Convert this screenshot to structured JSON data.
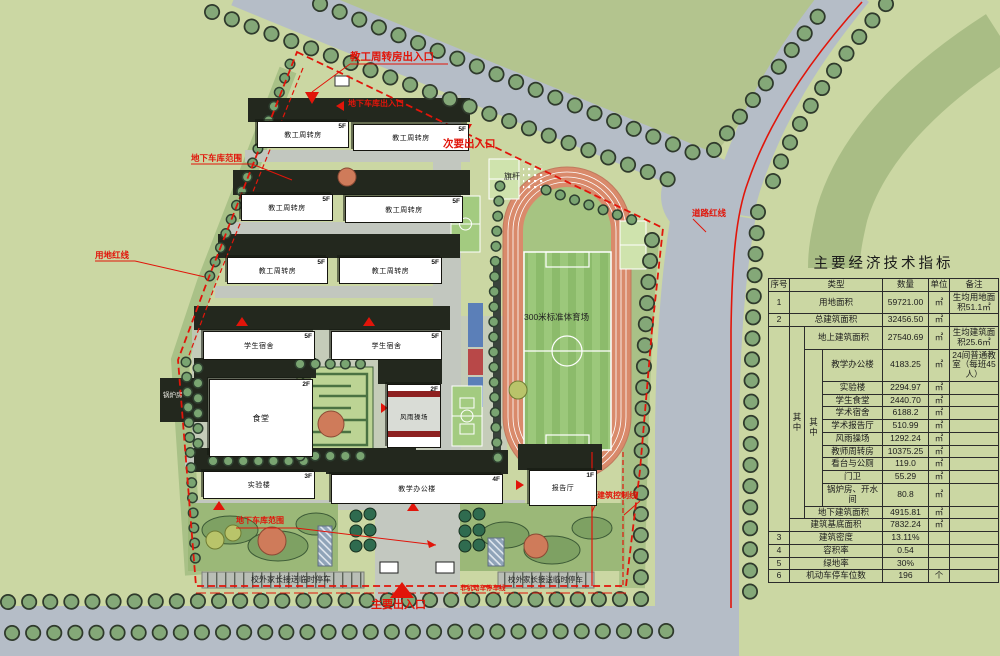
{
  "panel": {
    "title": "主要经济技术指标",
    "headers": {
      "no": "序号",
      "type": "类型",
      "qty": "数量",
      "unit": "单位",
      "note": "备注"
    },
    "zhong": "其中",
    "rows": [
      {
        "no": "1",
        "type": "用地面积",
        "qty": "59721.00",
        "unit": "㎡",
        "note": "生均用地面积51.1㎡"
      },
      {
        "no": "2",
        "type": "总建筑面积",
        "qty": "32456.50",
        "unit": "㎡",
        "note": ""
      },
      {
        "no": "",
        "type": "地上建筑面积",
        "qty": "27540.69",
        "unit": "㎡",
        "note": "生均建筑面积25.6㎡"
      },
      {
        "no": "",
        "type": "教学办公楼",
        "qty": "4183.25",
        "unit": "㎡",
        "note": "24间普通教室（每班45人）"
      },
      {
        "no": "",
        "type": "实验楼",
        "qty": "2294.97",
        "unit": "㎡",
        "note": ""
      },
      {
        "no": "",
        "type": "学生食堂",
        "qty": "2440.70",
        "unit": "㎡",
        "note": ""
      },
      {
        "no": "",
        "type": "学术宿舍",
        "qty": "6188.2",
        "unit": "㎡",
        "note": ""
      },
      {
        "no": "",
        "type": "学术报告厅",
        "qty": "510.99",
        "unit": "㎡",
        "note": ""
      },
      {
        "no": "",
        "type": "风雨操场",
        "qty": "1292.24",
        "unit": "㎡",
        "note": ""
      },
      {
        "no": "",
        "type": "教师周转房",
        "qty": "10375.25",
        "unit": "㎡",
        "note": ""
      },
      {
        "no": "",
        "type": "看台与公厕",
        "qty": "119.0",
        "unit": "㎡",
        "note": ""
      },
      {
        "no": "",
        "type": "门卫",
        "qty": "55.29",
        "unit": "㎡",
        "note": ""
      },
      {
        "no": "",
        "type": "锅炉房、开水间",
        "qty": "80.8",
        "unit": "㎡",
        "note": ""
      },
      {
        "no": "",
        "type": "地下建筑面积",
        "qty": "4915.81",
        "unit": "㎡",
        "note": ""
      },
      {
        "no": "",
        "type": "建筑基底面积",
        "qty": "7832.24",
        "unit": "㎡",
        "note": ""
      },
      {
        "no": "3",
        "type": "建筑密度",
        "qty": "13.11%",
        "unit": "",
        "note": ""
      },
      {
        "no": "4",
        "type": "容积率",
        "qty": "0.54",
        "unit": "",
        "note": ""
      },
      {
        "no": "5",
        "type": "绿地率",
        "qty": "30%",
        "unit": "",
        "note": ""
      },
      {
        "no": "6",
        "type": "机动车停车位数",
        "qty": "196",
        "unit": "个",
        "note": ""
      }
    ]
  },
  "plan": {
    "entrances": {
      "staff": "教工周转房出入口",
      "garage_entry": "地下车库出入口",
      "secondary": "次要出入口",
      "main": "主要出入口"
    },
    "lines": {
      "garage_extent_top": "地下车库范围",
      "garage_extent_bottom": "地下车库范围",
      "site_redline": "用地红线",
      "road_redline": "道路红线",
      "building_control": "建筑控制线",
      "nonmotor_parking": "非机动车停车线"
    },
    "labels": {
      "flagpole": "旗杆",
      "stadium": "300米标准体育场",
      "parking_left": "校外家长接送临时停车",
      "parking_right": "校外家长接送临时停车",
      "boiler": "锅炉房"
    },
    "buildings": [
      {
        "name": "教工周转房",
        "floor": "5F"
      },
      {
        "name": "教工周转房",
        "floor": "5F"
      },
      {
        "name": "教工周转房",
        "floor": "5F"
      },
      {
        "name": "教工周转房",
        "floor": "5F"
      },
      {
        "name": "教工周转房",
        "floor": "5F"
      },
      {
        "name": "教工周转房",
        "floor": "5F"
      },
      {
        "name": "学生宿舍",
        "floor": "5F"
      },
      {
        "name": "学生宿舍",
        "floor": "5F"
      },
      {
        "name": "食堂",
        "floor": "2F"
      },
      {
        "name": "风雨操场",
        "floor": "2F"
      },
      {
        "name": "实验楼",
        "floor": "3F"
      },
      {
        "name": "教学办公楼",
        "floor": "4F"
      },
      {
        "name": "报告厅",
        "floor": "1F"
      }
    ],
    "colors": {
      "redline": "#e1150a",
      "road": "#b5bdc7",
      "grass": "#cbd7a3",
      "track": "#d98a6b"
    }
  }
}
